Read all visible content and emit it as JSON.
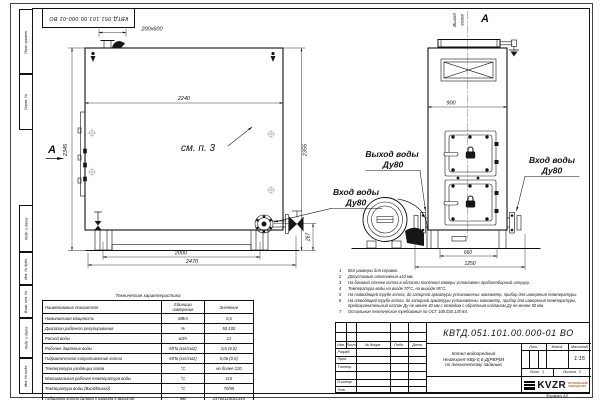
{
  "doc": {
    "number": "КВТД.051.101.00.000-01  ВО",
    "format": "Формат А3"
  },
  "margin_labels": [
    "Перв. примен.",
    "Справ. №",
    "Подп. и дата",
    "Инв. № дубл.",
    "Взам. инв. №",
    "Подп. и дата",
    "Инв. № подл."
  ],
  "side_view": {
    "section_mark": "А",
    "callout": "см. п. 3",
    "inlet_label": "Вход воды",
    "inlet_dn": "Ду80",
    "dims": {
      "chimney": "200х600",
      "width": "2240",
      "height_left": "2345",
      "height_right": "2355",
      "base_span": "2000",
      "length": "2470",
      "flange_h": "267"
    }
  },
  "front_view": {
    "view_mark": "А",
    "gas_out_1": "Выход",
    "gas_out_2": "газов",
    "outlet_label": "Выход воды",
    "outlet_dn": "Ду80",
    "inlet_label": "Вход воды",
    "inlet_dn": "Ду80",
    "dims": {
      "width": "900",
      "base_span": "660",
      "full_width": "1250"
    }
  },
  "notes": [
    {
      "n": "1",
      "text": "Все размеры для справок."
    },
    {
      "n": "2",
      "text": "Допустимые отклонения ±10 мм."
    },
    {
      "n": "3",
      "text": "На боковой стенке котла в области топочной камеры установлен пробоотборный штуцер."
    },
    {
      "n": "4",
      "text": "Температура воды на входе 70°С, на выходе 95°С."
    },
    {
      "n": "5",
      "text": "На подводящей трубе котла, до запорной арматуры установлены: манометр, прибор для измерения температуры."
    },
    {
      "n": "6",
      "text": "На отводящей трубе котла, до запорной арматуры установлены: манометр, прибор для измерения температуры, предохранительный клапан Ду не менее 40 мм с отводом с обратным клапаном Ду не менее 50 мм."
    },
    {
      "n": "7",
      "text": "Остальные технические требования по ОСТ 108.030.135-84."
    }
  ],
  "tech_table": {
    "title": "Техническая характеристика",
    "headers": [
      "Наименование показателя",
      "Единицы измерения",
      "Значение"
    ],
    "rows": [
      [
        "Номинальная мощность",
        "МВт",
        "0,6"
      ],
      [
        "Диапазон рабочего регулирования",
        "%",
        "50-100"
      ],
      [
        "Расход воды",
        "м3/ч",
        "21"
      ],
      [
        "Рабочее давление воды",
        "МПа (кгс/см2)",
        "0,6 (6,0)"
      ],
      [
        "Гидравлическое сопротивление котла",
        "МПа (кгс/см2)",
        "0,06 (0,6)"
      ],
      [
        "Температура уходящих газов",
        "°С",
        "не более 220"
      ],
      [
        "Максимальная рабочая температура воды",
        "°С",
        "115"
      ],
      [
        "Температура воды (Вход/Выход)",
        "°С",
        "70/95"
      ],
      [
        "Габариты котла (Длина х ширина х высота)",
        "мм",
        "2470х1250х2345"
      ]
    ]
  },
  "title_block": {
    "name_1": "Котел водогрейный",
    "name_2": "Heatexpert-КВр-0,6-Д(РВР)М",
    "name_3": "по техническому заданию",
    "cols": [
      "Изм.",
      "Лист",
      "№ докум.",
      "Подп.",
      "Дата"
    ],
    "rows": [
      "Разраб.",
      "Пров.",
      "Т.контр.",
      "",
      "Н.контр.",
      "Утв."
    ],
    "lit": "Лит.",
    "mass": "Масса",
    "scale": "Масштаб",
    "scale_value": "1:15",
    "sheet_label": "Лист",
    "sheet_value": "1",
    "sheets_label": "Листов",
    "sheets_value": "2",
    "logo": "KVZR",
    "logo_sub_1": "КОТЕЛЬНЫЙ",
    "logo_sub_2": "ЗАВОД РЭП"
  }
}
